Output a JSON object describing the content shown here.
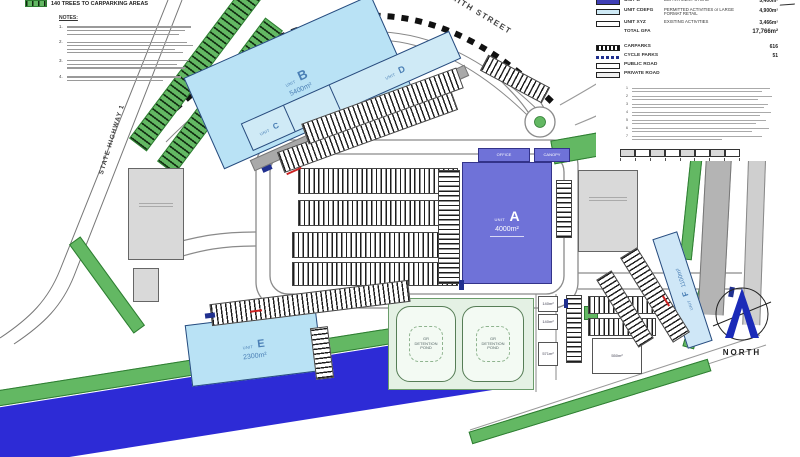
{
  "header_note": {
    "text": "140 TREES TO CARPARKING AREAS"
  },
  "notes": {
    "heading": "NOTES:",
    "numbers": [
      "1.",
      "2.",
      "3.",
      "4."
    ]
  },
  "roads": {
    "smith_street": "SMITH STREET",
    "state_highway": "STATE HIGHWAY 1"
  },
  "north_label": "NORTH",
  "unit_prefix": "UNIT",
  "units": {
    "a": {
      "letter": "A",
      "area": "4000m²"
    },
    "b": {
      "letter": "B",
      "area": "5400m²"
    },
    "c": {
      "letter": "C"
    },
    "d": {
      "letter": "D"
    },
    "e": {
      "letter": "E",
      "area": "2300m²"
    },
    "f": {
      "letter": "F",
      "area": "1100m²"
    }
  },
  "annotations": {
    "office": "OFFICE",
    "canopy": "CANOPY"
  },
  "pond": {
    "l1": "GR",
    "l2": "DETENTION",
    "l3": "POND"
  },
  "small_units": [
    "140m²",
    "140m²",
    "571m²",
    "550m²"
  ],
  "legend": {
    "rows": [
      {
        "label": "UNIT B",
        "desc": "DEPARTMENT STORE",
        "value": "5,400m²"
      },
      {
        "label": "UNIT CDEFG",
        "desc": "PERMITTED ACTIVITIES or LARGE FORMAT RETAIL",
        "value": "4,900m²"
      },
      {
        "label": "UNIT XYZ",
        "desc": "EXISTING ACTIVITIES",
        "value": "3,466m²"
      },
      {
        "label": "TOTAL GFA",
        "desc": "",
        "value": "17,766m²"
      },
      {
        "label": "CARPARKS",
        "desc": "",
        "value": "616"
      },
      {
        "label": "CYCLE PARKS",
        "desc": "",
        "value": "51"
      },
      {
        "label": "PUBLIC ROAD",
        "desc": "",
        "value": ""
      },
      {
        "label": "PRIVATE ROAD",
        "desc": "",
        "value": ""
      }
    ],
    "notes_numbers": [
      "1",
      "2",
      "3",
      "4",
      "5",
      "6",
      "7"
    ]
  }
}
